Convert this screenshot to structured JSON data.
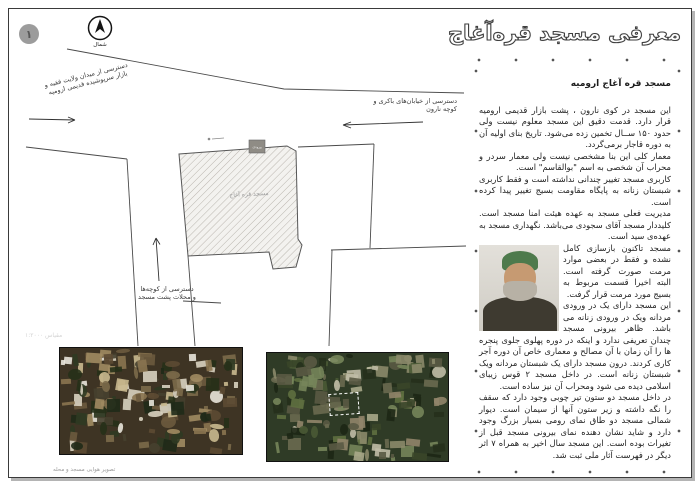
{
  "page": {
    "number": "۱"
  },
  "title": "معرفی مسجد قره‌آغاج",
  "north": {
    "label": "شمال"
  },
  "map": {
    "building_label": "مسجد قره آغاج",
    "entrance_label": "ورودی",
    "scale_label": "مقیاس ۱:۲۰۰۰",
    "access_left_line1": "دسترسی از میدان ولایت فقیه و",
    "access_left_line2": "بازار سرپوشیده قدیمی ارومیه",
    "access_right_line1": "دسترسی از خیابان‌های باکری و",
    "access_right_line2": "کوچه نارون",
    "access_bottom_line1": "دسترسی از کوچه‌ها",
    "access_bottom_line2": "و محلات پشت مسجد"
  },
  "article": {
    "heading": "مسجد قره آغاج ارومیه",
    "paragraphs": [
      "این مسجد در کوی نارون ، پشت بازار قدیمی ارومیه قرار دارد. قدمت دقیق این مسجد معلوم نیست ولی حدود ۱۵۰ ســال تخمین زده می‌شود. تاریخ بنای اولیه آن به دوره قاجار برمی‌گردد.",
      "معمار کلی این بنا مشخصی نیست ولی معمار سردر و محراب آن شخصی به اسم \"بوالقاسم\" است.",
      "کاربری مسجد تغییر چندانی نداشته است و فقط کاربری شبستان زنانه به پایگاه مقاومت بسیج تغییر پیدا کرده است.",
      "مدیریت فعلی مسجد به عهده هیئت امنا مسجد است. کلیددار مسجد آقای سجودی می‌باشد. نگهداری مسجد به عهده‌ی سید است.",
      "مسجد تاکنون بازسازی کامل نشده و فقط در بعضی موارد مرمت صورت گرفته است. البته اخیرا قسمت مربوط به بسیج مورد مرمت قرار گرفت.",
      "این مسجد دارای یک در ورودی مردانه ویک در ورودی زنانه می باشد. ظاهر بیرونی مسجد چندان تعریفی ندارد و اینکه در دوره پهلوی جلوی پنجره ها را آن زمان با آن مصالح و معماری خاص آن دوره آجر کاری کردند. درون مسجد دارای یک شبستان مردانه ویک شبستان زنانه است. در داخل مسجد ۲ قوس زیبای اسلامی دیده می شود ومحراب آن نیز ساده است.",
      "در داخل مسجد دو ستون تیر چوبی وجود دارد که سقف را نگه داشته و زیر ستون آنها از سیمان است. دیوار شمالی مسجد دو طاق نمای رومی بسیار بزرگ وجود دارد و شاید نشان دهنده نمای بیرونی مسجد قبل از تغیرات بوده است. این مسجد سال اخیر به همراه ۷ اثر دیگر در فهرست آثار ملی ثبت شد."
    ]
  },
  "photos": {
    "caption_left": "تصویر هوایی مسجد و محله",
    "aerial1": {
      "seed": 123457,
      "count": 150,
      "base": "#3e3424",
      "palette": [
        "#6b5a3e",
        "#8a7450",
        "#a08b62",
        "#2f3a22",
        "#1f2a18",
        "#c9b98f",
        "#46402f",
        "#d8d2c0",
        "#5c4a33",
        "#7b6a4a",
        "#e8e4da",
        "#263018"
      ]
    },
    "aerial2": {
      "seed": 987653,
      "count": 150,
      "base": "#2f3b26",
      "palette": [
        "#4a5a35",
        "#5f7040",
        "#76855a",
        "#3a4629",
        "#8b8a6a",
        "#a9a98a",
        "#26301c",
        "#5a5a44",
        "#91856a",
        "#c0bca6",
        "#6a6a50",
        "#1d2715"
      ]
    }
  },
  "colors": {
    "page_border": "#3a3a3a",
    "badge_fill": "#9c9c9c",
    "hatch": "#b9b5ae",
    "road_line": "#4a4a4a"
  }
}
